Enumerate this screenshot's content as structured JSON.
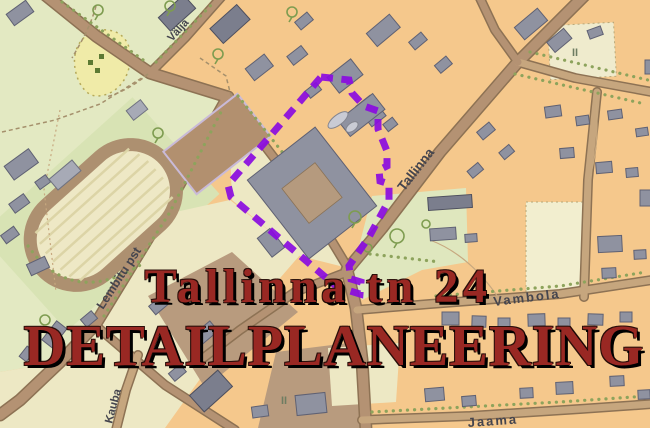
{
  "title": {
    "line1": "Tallinna tn 24",
    "line2": "DETAILPLANEERING",
    "color": "#992823"
  },
  "boundary": {
    "description": "planning area boundary",
    "color": "#8a0bdf",
    "path": "M321 77 L349 80 L352 93 L364 106 L378 111 L378 129 L387 151 L387 166 L379 170 L380 181 L389 184 L389 200 L369 237 L349 266 L351 279 L361 282 L360 294 L337 287 L231 197 L228 185 L321 77"
  },
  "streets": [
    {
      "id": "valja",
      "text": "Välja"
    },
    {
      "id": "tallinna",
      "text": "Tallinna"
    },
    {
      "id": "lembitu",
      "text": "Lembitu pst"
    },
    {
      "id": "kauba",
      "text": "Kauba"
    },
    {
      "id": "vambola",
      "text": "Vambola"
    },
    {
      "id": "jaama",
      "text": "Jaama"
    }
  ],
  "marks": [
    {
      "text": "II"
    },
    {
      "text": "II"
    }
  ],
  "palette": {
    "block_orange": "#f5c88c",
    "block_cream": "#ede8c4",
    "park_green": "#e3e9c2",
    "stadium_green": "#d8e3b4",
    "meadow_yellow": "#f0eba8",
    "road_fill": "#b49273",
    "road_light": "#c6a67e",
    "road_casing": "#8d7254",
    "building_gray": "#8f92a0",
    "field_brown": "#b2906f",
    "dirt_brown": "#b89b7e",
    "tree_green": "#7e9c50",
    "boundary_purple": "#8a0bdf",
    "title_red": "#992823"
  }
}
